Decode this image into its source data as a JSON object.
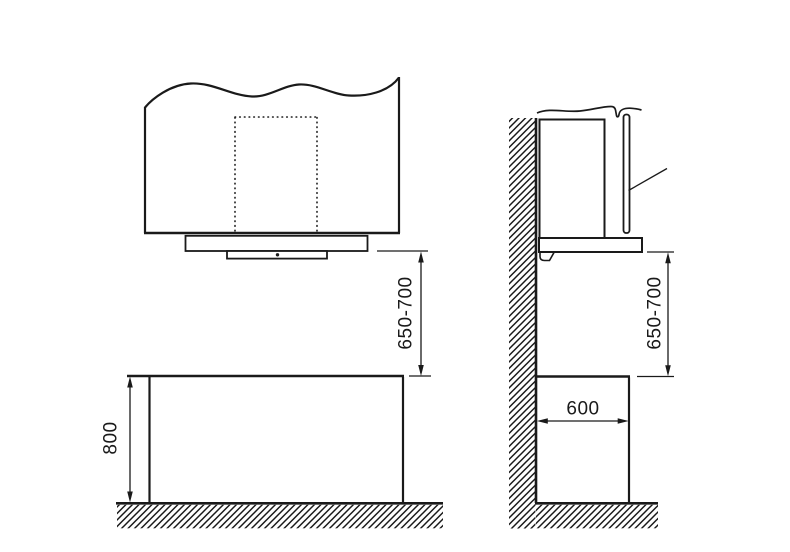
{
  "diagram": {
    "dimensions": {
      "front_clearance": "650-700",
      "counter_height": "800",
      "side_clearance": "650-700",
      "counter_depth": "600"
    }
  }
}
